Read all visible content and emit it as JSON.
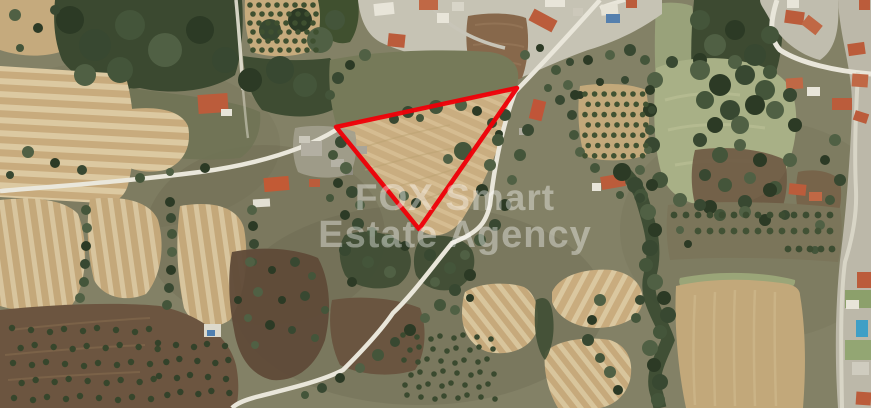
{
  "image": {
    "kind_label": "satellite aerial view with land plot outline",
    "width_px": 871,
    "height_px": 408
  },
  "watermark": {
    "line1": "FOX Smart",
    "line2": "Estate Agency",
    "color": "#ffffff",
    "opacity": "0.38"
  },
  "boundary": {
    "points": "336,127 517,88 419,229",
    "color": "#ee0008",
    "stroke_width": "4.5"
  }
}
